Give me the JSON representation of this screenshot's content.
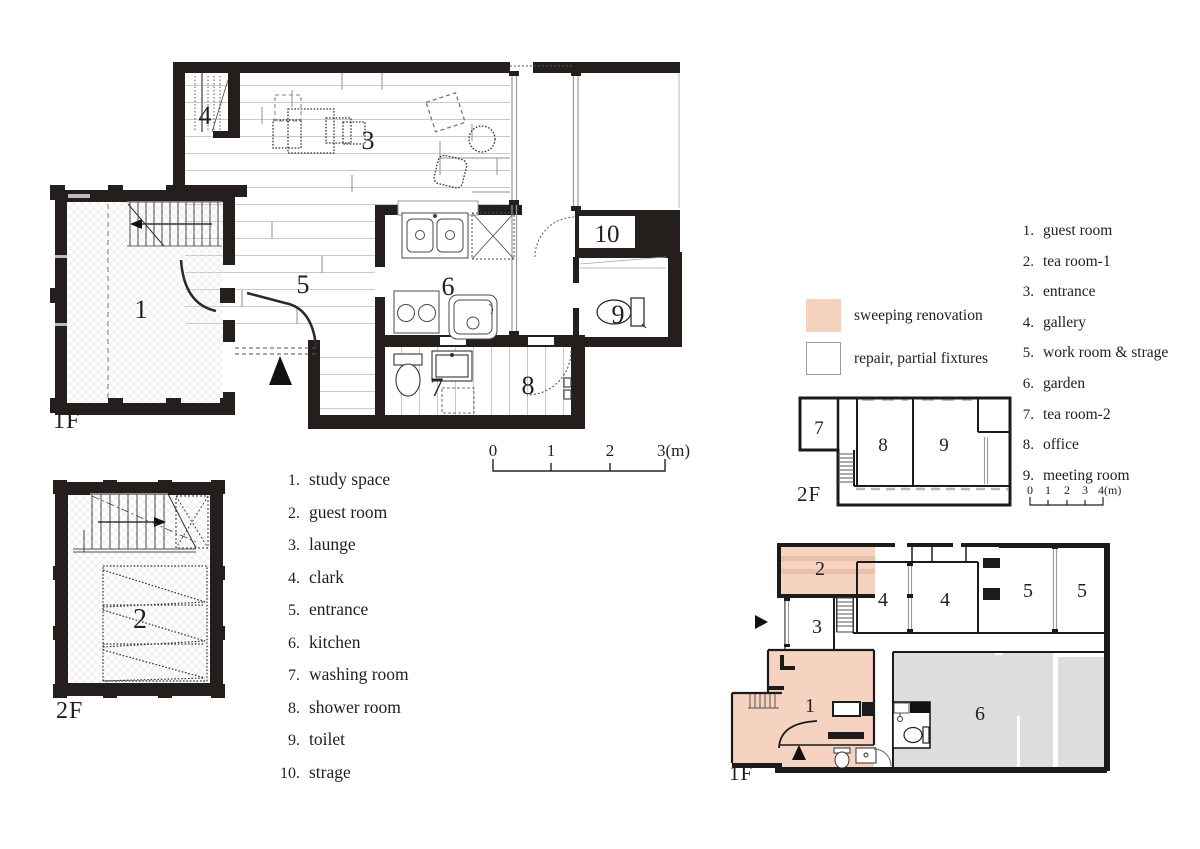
{
  "colors": {
    "sweeping_renovation": "#f6d3c0",
    "sweeping_stripe": "#eac0aa",
    "repair_fill": "#ffffff",
    "garden_gray": "#dedddb",
    "wall_black": "#241f1c"
  },
  "left": {
    "f1_label": "1F",
    "f2_label": "2F",
    "rooms_1f": {
      "n1": "1",
      "n3": "3",
      "n4": "4",
      "n5": "5",
      "n6": "6",
      "n7": "7",
      "n8": "8",
      "n9": "9",
      "n10": "10"
    },
    "rooms_2f": {
      "n2": "2"
    },
    "legend_items": [
      {
        "num": "1.",
        "label": "study space"
      },
      {
        "num": "2.",
        "label": "guest room"
      },
      {
        "num": "3.",
        "label": "launge"
      },
      {
        "num": "4.",
        "label": "clark"
      },
      {
        "num": "5.",
        "label": "entrance"
      },
      {
        "num": "6.",
        "label": "kitchen"
      },
      {
        "num": "7.",
        "label": "washing room"
      },
      {
        "num": "8.",
        "label": "shower room"
      },
      {
        "num": "9.",
        "label": "toilet"
      },
      {
        "num": "10.",
        "label": "strage"
      }
    ],
    "scale_ticks": [
      "0",
      "1",
      "2",
      "3(m)"
    ]
  },
  "right": {
    "f1_label": "1F",
    "f2_label": "2F",
    "swatches": [
      {
        "label": "sweeping renovation"
      },
      {
        "label": "repair, partial fixtures"
      }
    ],
    "legend_items": [
      {
        "num": "1.",
        "label": "guest room"
      },
      {
        "num": "2.",
        "label": "tea room-1"
      },
      {
        "num": "3.",
        "label": "entrance"
      },
      {
        "num": "4.",
        "label": "gallery"
      },
      {
        "num": "5.",
        "label": "work room & strage"
      },
      {
        "num": "6.",
        "label": "garden"
      },
      {
        "num": "7.",
        "label": "tea room-2"
      },
      {
        "num": "8.",
        "label": "office"
      },
      {
        "num": "9.",
        "label": "meeting room"
      }
    ],
    "rooms_2f": {
      "n7": "7",
      "n8": "8",
      "n9": "9"
    },
    "rooms_1f": {
      "n1": "1",
      "n2": "2",
      "n3": "3",
      "n4a": "4",
      "n4b": "4",
      "n5a": "5",
      "n5b": "5",
      "n6": "6"
    },
    "scale_ticks": [
      "0",
      "1",
      "2",
      "3",
      "4(m)"
    ]
  }
}
